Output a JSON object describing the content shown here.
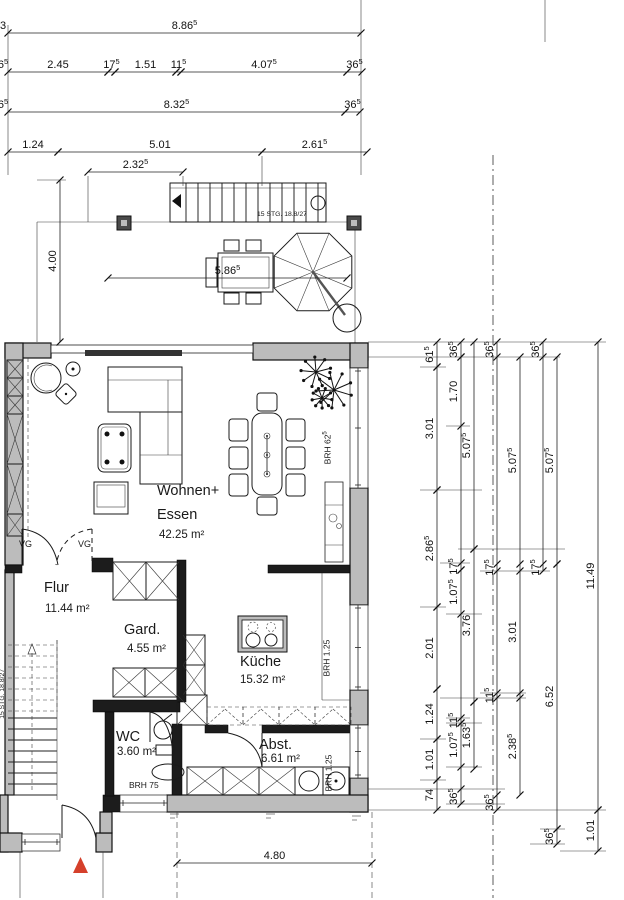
{
  "meta": {
    "drawing_type": "floor-plan",
    "language": "de"
  },
  "colors": {
    "background": "#ffffff",
    "wall_fill": "#bcbcbc",
    "wall_dark": "#1c1c1c",
    "line": "#1a1a1a",
    "entrance_marker": "#d5402b"
  },
  "rooms": {
    "wohnen": {
      "l1": "Wohnen+",
      "l2": "Essen",
      "area": "42.25 m²"
    },
    "flur": {
      "name": "Flur",
      "area": "11.44 m²"
    },
    "gard": {
      "name": "Gard.",
      "area": "4.55 m²"
    },
    "kueche": {
      "name": "Küche",
      "area": "15.32 m²"
    },
    "wc": {
      "name": "WC",
      "area": "3.60 m²"
    },
    "abst": {
      "name": "Abst.",
      "area": "6.61 m²"
    }
  },
  "annotations": {
    "brh1": {
      "main": "BRH 62",
      "sup": "5"
    },
    "brh2": {
      "main": "BRH 1.25",
      "sup": ""
    },
    "brh3": {
      "main": "BRH 1.25",
      "sup": ""
    },
    "brh_wc": {
      "main": "BRH 75",
      "sup": ""
    },
    "stair_top": "15 STG. 18.8/27",
    "stair_inner": "15 STG. 18.8/27",
    "vg1": "VG",
    "vg2": "VG"
  },
  "dimensions": {
    "h_chains": [
      {
        "y": 33,
        "frag": {
          "l": "3",
          "s": ""
        },
        "segs": [
          {
            "l": "8.86",
            "s": "5",
            "f": 8,
            "t": 361
          }
        ]
      },
      {
        "y": 72,
        "frag": {
          "l": "6",
          "s": "5"
        },
        "segs": [
          {
            "l": "2.45",
            "s": "",
            "f": 8,
            "t": 108
          },
          {
            "l": "17",
            "s": "5",
            "f": 108,
            "t": 115
          },
          {
            "l": "1.51",
            "s": "",
            "f": 115,
            "t": 176
          },
          {
            "l": "11",
            "s": "5",
            "f": 176,
            "t": 181
          },
          {
            "l": "4.07",
            "s": "5",
            "f": 181,
            "t": 347
          },
          {
            "l": "36",
            "s": "5",
            "f": 347,
            "t": 362
          }
        ]
      },
      {
        "y": 112,
        "frag": {
          "l": "6",
          "s": "5"
        },
        "segs": [
          {
            "l": "8.32",
            "s": "5",
            "f": 8,
            "t": 345
          },
          {
            "l": "36",
            "s": "5",
            "f": 345,
            "t": 360
          }
        ]
      },
      {
        "y": 152,
        "segs": [
          {
            "l": "1.24",
            "s": "",
            "f": 8,
            "t": 58
          },
          {
            "l": "5.01",
            "s": "",
            "f": 58,
            "t": 262
          },
          {
            "l": "2.61",
            "s": "5",
            "f": 262,
            "t": 367
          }
        ]
      },
      {
        "y": 172,
        "segs": [
          {
            "l": "2.32",
            "s": "5",
            "f": 88,
            "t": 183
          }
        ]
      },
      {
        "y": 278,
        "segs": [
          {
            "l": "5.86",
            "s": "5",
            "f": 108,
            "t": 347
          }
        ]
      },
      {
        "y": 863,
        "segs": [
          {
            "l": "4.80",
            "s": "",
            "f": 177,
            "t": 372
          }
        ]
      }
    ],
    "v_chains": [
      {
        "x": 60,
        "segs": [
          {
            "l": "4.00",
            "s": "",
            "f": 180,
            "t": 342
          }
        ]
      },
      {
        "x": 437,
        "segs": [
          {
            "l": "61",
            "s": "5",
            "f": 342,
            "t": 367
          },
          {
            "l": "3.01",
            "s": "",
            "f": 367,
            "t": 490
          },
          {
            "l": "2.86",
            "s": "5",
            "f": 490,
            "t": 607
          },
          {
            "l": "2.01",
            "s": "",
            "f": 607,
            "t": 689
          },
          {
            "l": "1.24",
            "s": "",
            "f": 689,
            "t": 739
          },
          {
            "l": "1.01",
            "s": "",
            "f": 739,
            "t": 780
          },
          {
            "l": "74",
            "s": "",
            "f": 780,
            "t": 810
          }
        ]
      },
      {
        "x": 461,
        "segs": [
          {
            "l": "36",
            "s": "5",
            "f": 342,
            "t": 357
          },
          {
            "l": "1.70",
            "s": "",
            "f": 357,
            "t": 426
          },
          {
            "l": "17",
            "s": "5",
            "f": 563,
            "t": 570
          },
          {
            "l": "1.07",
            "s": "5",
            "f": 570,
            "t": 614
          },
          {
            "l": "11",
            "s": "5",
            "f": 718,
            "t": 723
          },
          {
            "l": "1.07",
            "s": "5",
            "f": 723,
            "t": 767
          },
          {
            "l": "36",
            "s": "5",
            "f": 789,
            "t": 804
          }
        ]
      },
      {
        "x": 474,
        "segs": [
          {
            "l": "5.07",
            "s": "5",
            "f": 342,
            "t": 549
          },
          {
            "l": "3.76",
            "s": "",
            "f": 549,
            "t": 702
          },
          {
            "l": "1.63",
            "s": "5",
            "f": 702,
            "t": 769
          }
        ]
      },
      {
        "x": 497,
        "segs": [
          {
            "l": "36",
            "s": "5",
            "f": 342,
            "t": 357
          },
          {
            "l": "17",
            "s": "5",
            "f": 564,
            "t": 571
          },
          {
            "l": "11",
            "s": "5",
            "f": 693,
            "t": 698
          },
          {
            "l": "36",
            "s": "5",
            "f": 795,
            "t": 810
          }
        ]
      },
      {
        "x": 520,
        "segs": [
          {
            "l": "5.07",
            "s": "5",
            "f": 357,
            "t": 564
          },
          {
            "l": "3.01",
            "s": "",
            "f": 571,
            "t": 693
          },
          {
            "l": "2.38",
            "s": "5",
            "f": 698,
            "t": 795
          }
        ]
      },
      {
        "x": 543,
        "segs": [
          {
            "l": "36",
            "s": "5",
            "f": 342,
            "t": 357
          },
          {
            "l": "17",
            "s": "5",
            "f": 564,
            "t": 571
          }
        ]
      },
      {
        "x": 557,
        "segs": [
          {
            "l": "5.07",
            "s": "5",
            "f": 357,
            "t": 564
          },
          {
            "l": "6.52",
            "s": "",
            "f": 564,
            "t": 829
          },
          {
            "l": "36",
            "s": "5",
            "f": 829,
            "t": 844
          }
        ]
      },
      {
        "x": 598,
        "segs": [
          {
            "l": "11.49",
            "s": "",
            "f": 342,
            "t": 810
          },
          {
            "l": "1.01",
            "s": "",
            "f": 810,
            "t": 851
          }
        ]
      }
    ]
  }
}
